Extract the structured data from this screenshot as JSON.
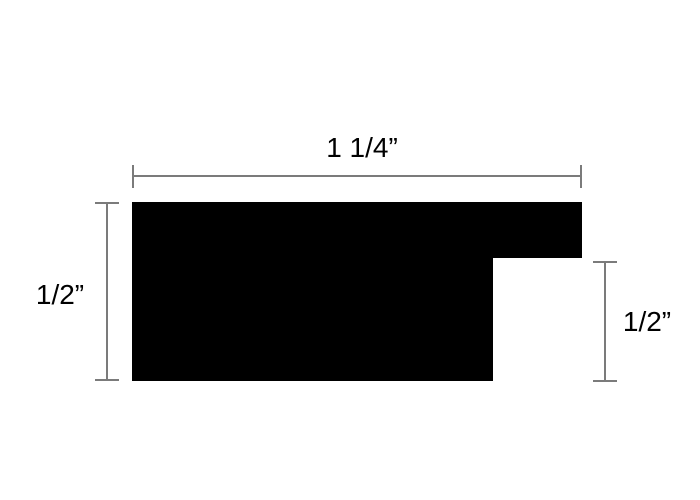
{
  "diagram": {
    "kind": "profile-cross-section",
    "dimensions": {
      "top": {
        "label": "1 1/4”"
      },
      "left": {
        "label": "1/2”"
      },
      "right": {
        "label": "1/2”"
      }
    },
    "colors": {
      "background": "#ffffff",
      "shape": "#000000",
      "dimension_line": "#7b7b7b",
      "label_text": "#000000"
    }
  }
}
